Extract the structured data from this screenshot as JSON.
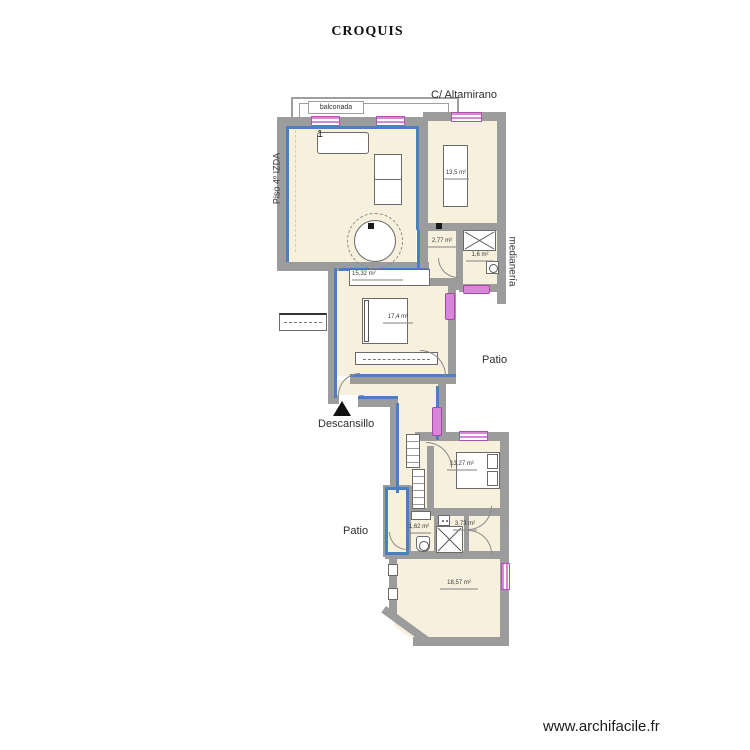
{
  "title": "CROQUIS",
  "watermark": "www.archifacile.fr",
  "labels": {
    "street": "C/ Altamirano",
    "balcony": "balconada",
    "floor": "Piso 4º IZDA",
    "party_wall": "medianería",
    "patio_right": "Patio",
    "patio_left": "Patio",
    "landing": "Descansillo",
    "furniture_number": "1"
  },
  "rooms": {
    "bedroom_top_right": {
      "area": "13,5 m²"
    },
    "hall": {
      "area": "2,77 m²"
    },
    "storage": {
      "area": "1,6 m²"
    },
    "wardrobe": {
      "area": "15,32 m²"
    },
    "bedroom_middle": {
      "area": "17,4 m²"
    },
    "bedroom_bottom": {
      "area": "13,27 m²"
    },
    "wc": {
      "area": "1,62 m²"
    },
    "bathroom": {
      "area": "3,73 m²"
    },
    "salon_bottom": {
      "area": "18,57 m²"
    }
  },
  "colors": {
    "wall_gray": "#9c9c9c",
    "selection_blue": "#4a80c2",
    "floor_cream": "#f6f0dc",
    "opening_pink": "#d887d8"
  }
}
